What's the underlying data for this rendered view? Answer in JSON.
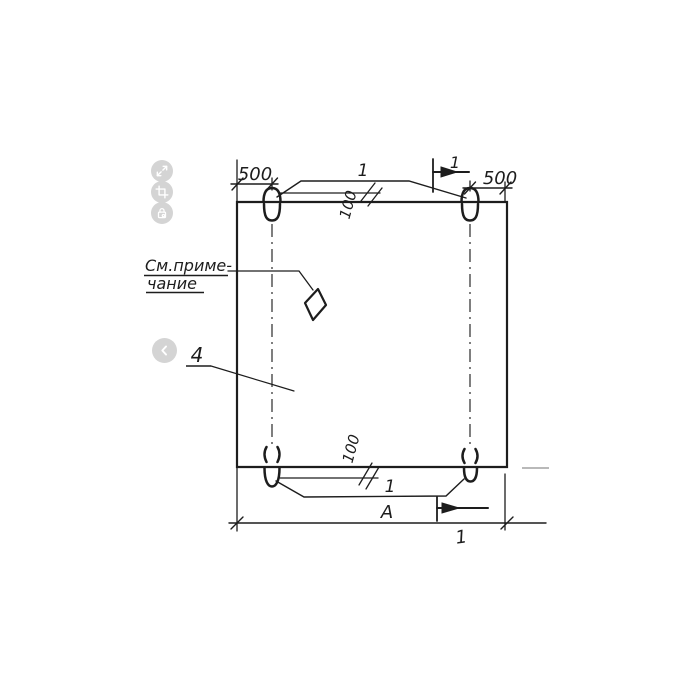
{
  "viewer": {
    "background": "#ffffff",
    "toolbar": {
      "button_color": "#d4d4d4",
      "buttons": [
        {
          "name": "expand",
          "icon": "expand-icon"
        },
        {
          "name": "crop",
          "icon": "crop-icon"
        },
        {
          "name": "lock",
          "icon": "lock-icon"
        }
      ]
    },
    "carousel": {
      "prev_icon": "chevron-left-icon"
    }
  },
  "drawing": {
    "type": "engineering-drawing",
    "stroke_color": "#1d1d1d",
    "labels": {
      "dim_top_left": "500",
      "dim_top_right": "500",
      "dim_offset_top": "100",
      "dim_offset_bottom": "100",
      "callout_loops_top": "1",
      "callout_loops_bottom": "1",
      "section_top": "1",
      "section_bottom": "1",
      "note_line1": "См.приме-",
      "note_line2": "чание",
      "panel_callout": "4",
      "width_dim": "А"
    }
  }
}
